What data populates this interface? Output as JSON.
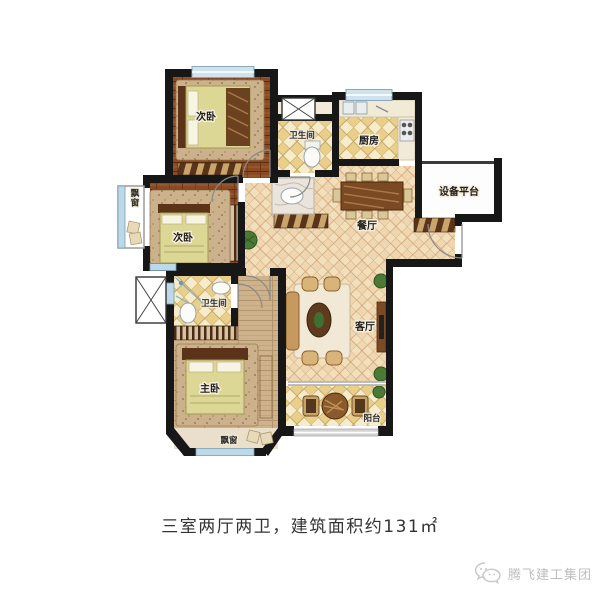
{
  "image_type": "apartment-floor-plan",
  "plan": {
    "room_labels": {
      "bedroom_top": "次卧",
      "bathroom_top": "卫生间",
      "kitchen": "厨房",
      "equipment_platform": "设备平台",
      "dining_room": "餐厅",
      "bedroom_mid": "次卧",
      "bay_window_left": "飘窗",
      "bathroom_mid": "卫生间",
      "living_room": "客厅",
      "master_bedroom": "主卧",
      "bay_window_bottom": "飘窗",
      "balcony": "阳台"
    },
    "colors": {
      "wall": "#171717",
      "wood_dark": "#8a4a24",
      "wood_light": "#cdb28b",
      "tile_cream": "#f6eccb",
      "tile_gold": "#e9cf8a",
      "hall_tile": "#f2e0bd",
      "window_blue": "#bcd9ea",
      "bed_fill": "#dcd795"
    }
  },
  "caption": "三室两厅两卫，建筑面积约131㎡",
  "watermark": {
    "brand": "腾飞建工集团"
  }
}
